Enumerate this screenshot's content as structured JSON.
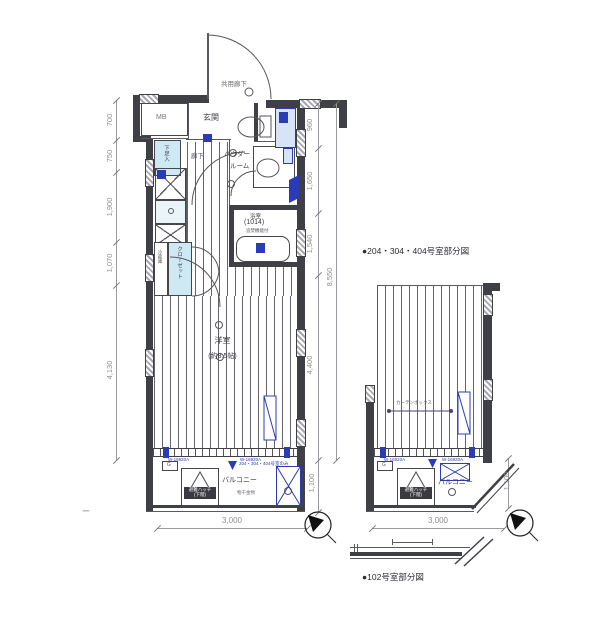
{
  "colors": {
    "wall": "#3f4046",
    "accent_blue": "#2b3bb5",
    "light_blue": "#cfe9f4",
    "dim_gray": "#8e8e95"
  },
  "main_plan": {
    "common_corridor": "共用廊下",
    "mb": "MB",
    "entrance": "玄関",
    "corridor": "廊下",
    "shoe_box": "下足入",
    "powder1": "パウダー",
    "powder2": "ルーム",
    "bath": "浴室",
    "bath_size": "(1014)",
    "bath_note": "追焚機能付",
    "fridge": "冷蔵庫",
    "closet": "クローゼット",
    "room": "洋室",
    "room_size": "(約8.5帖)",
    "g_mark": "G",
    "hatch1": "避難ハッチ",
    "hatch2": "(下階)",
    "balcony": "バルコニー",
    "balcony_note": "204・304・404号室のみ",
    "monohoshi": "物干金物",
    "win_note_l": "W-16920A",
    "win_note_r": "W-16920A",
    "dims_left": [
      "700",
      "750",
      "1,900",
      "1,070",
      "4,130"
    ],
    "dims_right": [
      "960",
      "1,650",
      "1,540",
      "4,400"
    ],
    "dim_total": "8,550",
    "dim_balcony": "1,100",
    "dim_bottom": "3,000"
  },
  "right_plan": {
    "caption": "●204・304・404号室部分図",
    "g_mark": "G",
    "hatch1": "避難ハッチ",
    "hatch2": "(下階)",
    "balcony": "バルコニー",
    "curtain_note": "カーテンボックス",
    "win_note_l": "W-16920A",
    "win_note_r": "W-16920A",
    "dim_bottom": "3,000",
    "dim_balcony": "1,100"
  },
  "bottom_detail": {
    "caption": "●102号室部分図"
  },
  "misc": {
    "left_dash": "ー"
  }
}
